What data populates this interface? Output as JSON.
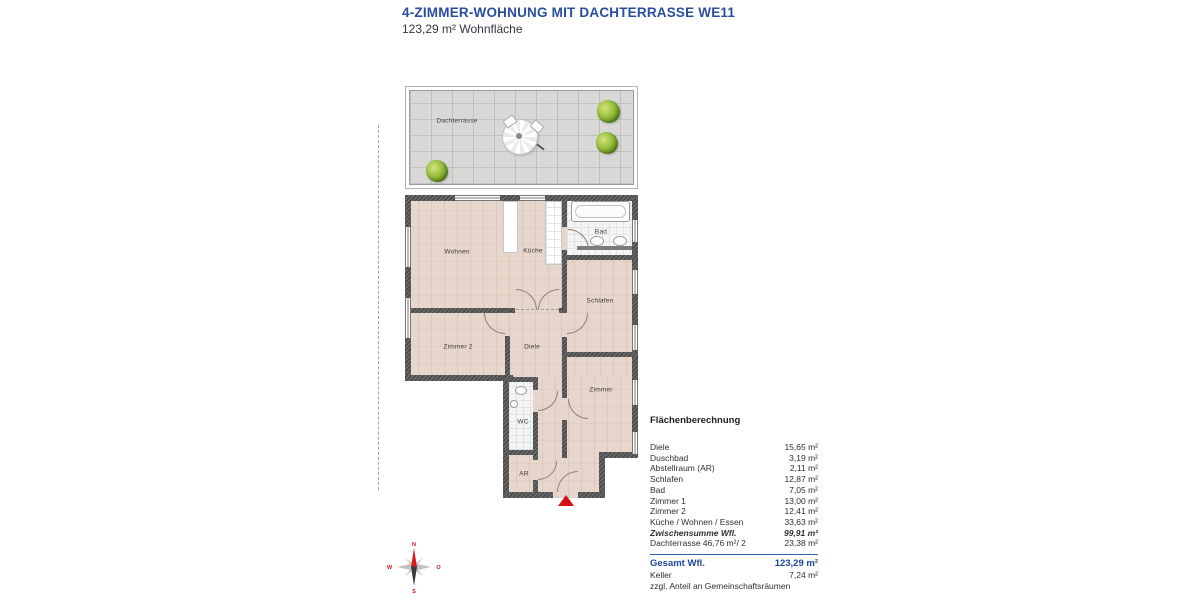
{
  "header": {
    "title": "4-ZIMMER-WOHNUNG MIT DACHTERRASSE WE11",
    "subtitle": "123,29 m² Wohnfläche"
  },
  "plan": {
    "labels": {
      "dachterrasse": "Dachterrasse",
      "wohnen": "Wohnen",
      "kueche": "Küche",
      "bad": "Bad",
      "schlafen": "Schlafen",
      "zimmer2": "Zimmer 2",
      "diele": "Diele",
      "zimmer": "Zimmer",
      "wc": "WC",
      "ar": "AR"
    }
  },
  "compass": {
    "n": "N",
    "w": "W",
    "o": "O",
    "s": "S"
  },
  "table": {
    "heading": "Flächenberechnung",
    "rows": [
      {
        "label": "Diele",
        "value": "15,65 m²"
      },
      {
        "label": "Duschbad",
        "value": "3,19 m²"
      },
      {
        "label": "Abstellraum (AR)",
        "value": "2,11 m²"
      },
      {
        "label": "Schlafen",
        "value": "12,87 m²"
      },
      {
        "label": "Bad",
        "value": "7,05 m²"
      },
      {
        "label": "Zimmer 1",
        "value": "13,00 m²"
      },
      {
        "label": "Zimmer 2",
        "value": "12,41 m²"
      },
      {
        "label": "Küche / Wohnen / Essen",
        "value": "33,63 m²"
      },
      {
        "label": "Zwischensumme Wfl.",
        "value": "99,91 m²"
      },
      {
        "label": "Dachterrasse  46,76 m²/ 2",
        "value": "23,38 m²"
      }
    ],
    "total": {
      "label": "Gesamt Wfl.",
      "value": "123,29 m²"
    },
    "keller": {
      "label": "Keller",
      "value": "7,24 m²"
    },
    "footnote": "zzgl. Anteil an Gemeinschaftsräumen"
  },
  "colors": {
    "accent_blue": "#2b4da0",
    "marker_red": "#d21114"
  }
}
